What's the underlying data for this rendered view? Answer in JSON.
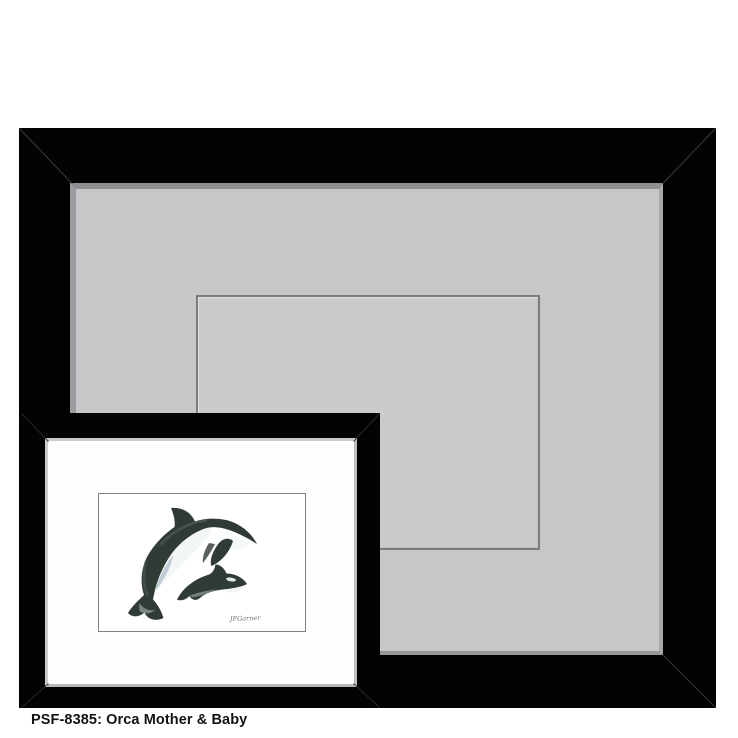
{
  "product": {
    "caption": "PSF-8385: Orca Mother & Baby",
    "sku": "PSF-8385",
    "title": "Orca Mother & Baby"
  },
  "artwork": {
    "signature": "JFGarner",
    "colors": {
      "body": "#303b36",
      "body_light": "#5c6c64",
      "belly": "#f2f6f7",
      "eye_patch": "#fbfdfd",
      "shade": "#b4c3cb"
    }
  },
  "palette": {
    "frame_black": "#030303",
    "big_mat_gray": "#c7c7c9",
    "mat_window_fill": "#cbcbce",
    "mat_window_line": "#7c7c7f",
    "small_mat_white": "#fdfdfd",
    "page_background": "#ffffff",
    "caption_color": "#141414"
  }
}
